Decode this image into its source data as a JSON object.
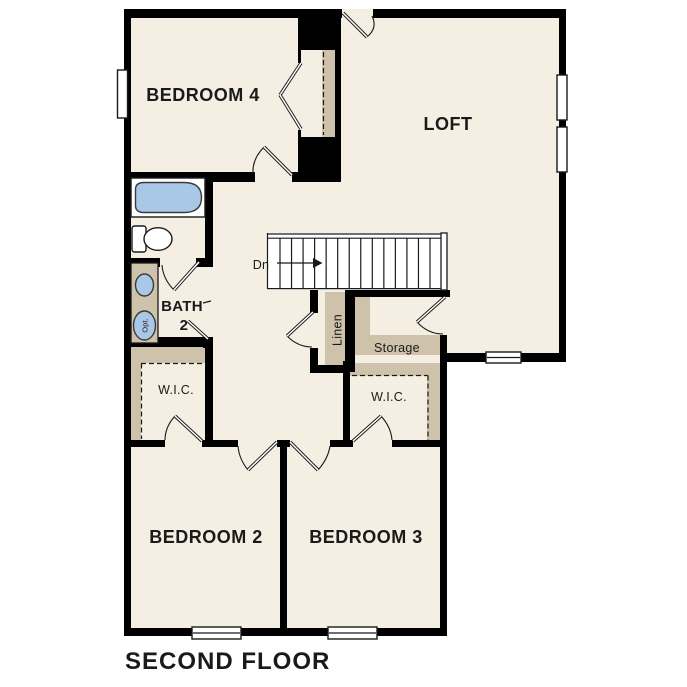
{
  "title": "SECOND FLOOR",
  "rooms": {
    "bedroom4": "BEDROOM 4",
    "loft": "LOFT",
    "bedroom2": "BEDROOM 2",
    "bedroom3": "BEDROOM 3",
    "bath": {
      "line1": "BATH",
      "line2": "2"
    },
    "wic_left": "W.I.C.",
    "wic_right": "W.I.C.",
    "linen": "Linen",
    "storage": "Storage"
  },
  "stairs": {
    "direction": "Dn"
  },
  "fixtures": {
    "optional": "Opt."
  },
  "colors": {
    "wall": "#000000",
    "floor": "#f5eee2",
    "closet_tan": "#cec2aa",
    "fixture_blue": "#a9c7e6",
    "background": "#ffffff"
  }
}
